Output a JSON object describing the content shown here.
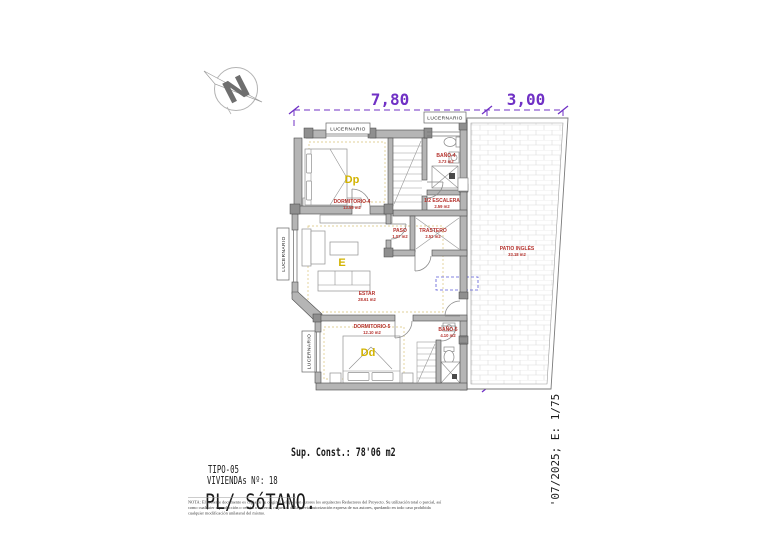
{
  "labels": {
    "lucernario": "LUCERNARIO",
    "north": "N"
  },
  "dimensions": {
    "width_main": "7,80",
    "width_patio": "3,00",
    "height": "11,06"
  },
  "rooms": {
    "dormitorio4": {
      "code": "Dp",
      "name": "DORMITORIO-4",
      "area": "13.58 m2"
    },
    "bano4": {
      "name": "BAÑO-4",
      "area": "3.73 m2"
    },
    "escalera": {
      "name": "1/2 ESCALERA",
      "area": "2.59 m2"
    },
    "paso": {
      "name": "PASO",
      "area": "1.07 m2"
    },
    "trastero": {
      "name": "TRASTERO",
      "area": "2.52 m2"
    },
    "estar": {
      "code": "E",
      "name": "ESTAR",
      "area": "28.61 m2"
    },
    "dormitorio5": {
      "code": "Dd",
      "name": "DORMITORIO-5",
      "area": "12.10 m2"
    },
    "bano5": {
      "name": "BAÑO-5",
      "area": "4.10 m2"
    },
    "patio": {
      "name": "PATIO INGLÉS",
      "area": "33.18 m2"
    }
  },
  "title_block": {
    "sup_const": "Sup. Const.: 78'06 m2",
    "tipo": "TIPO-05",
    "viviendas": "VIVIENDAs Nº: 18",
    "planta": "PL/ SóTANO.",
    "date_scale": "'07/2025; E: 1/75",
    "nota_line1": "NOTA: El presente documento es copia de su original del que son autores los arquitectos Redactores del Proyecto. Su utilización total o parcial, así",
    "nota_line2": "como cualquier reproducción o cesión a terceros, requerirá de la previa autorización expresa de sus autores, quedando en todo caso prohibida",
    "nota_line3": "cualquier modificación unilateral del mismo."
  },
  "colors": {
    "dimension_purple": "#7031c5",
    "room_label_red": "#b5332e",
    "room_code_yellow": "#d2b300",
    "sup_const_red": "#cf2020",
    "wall_gray": "#b5b5b5"
  }
}
